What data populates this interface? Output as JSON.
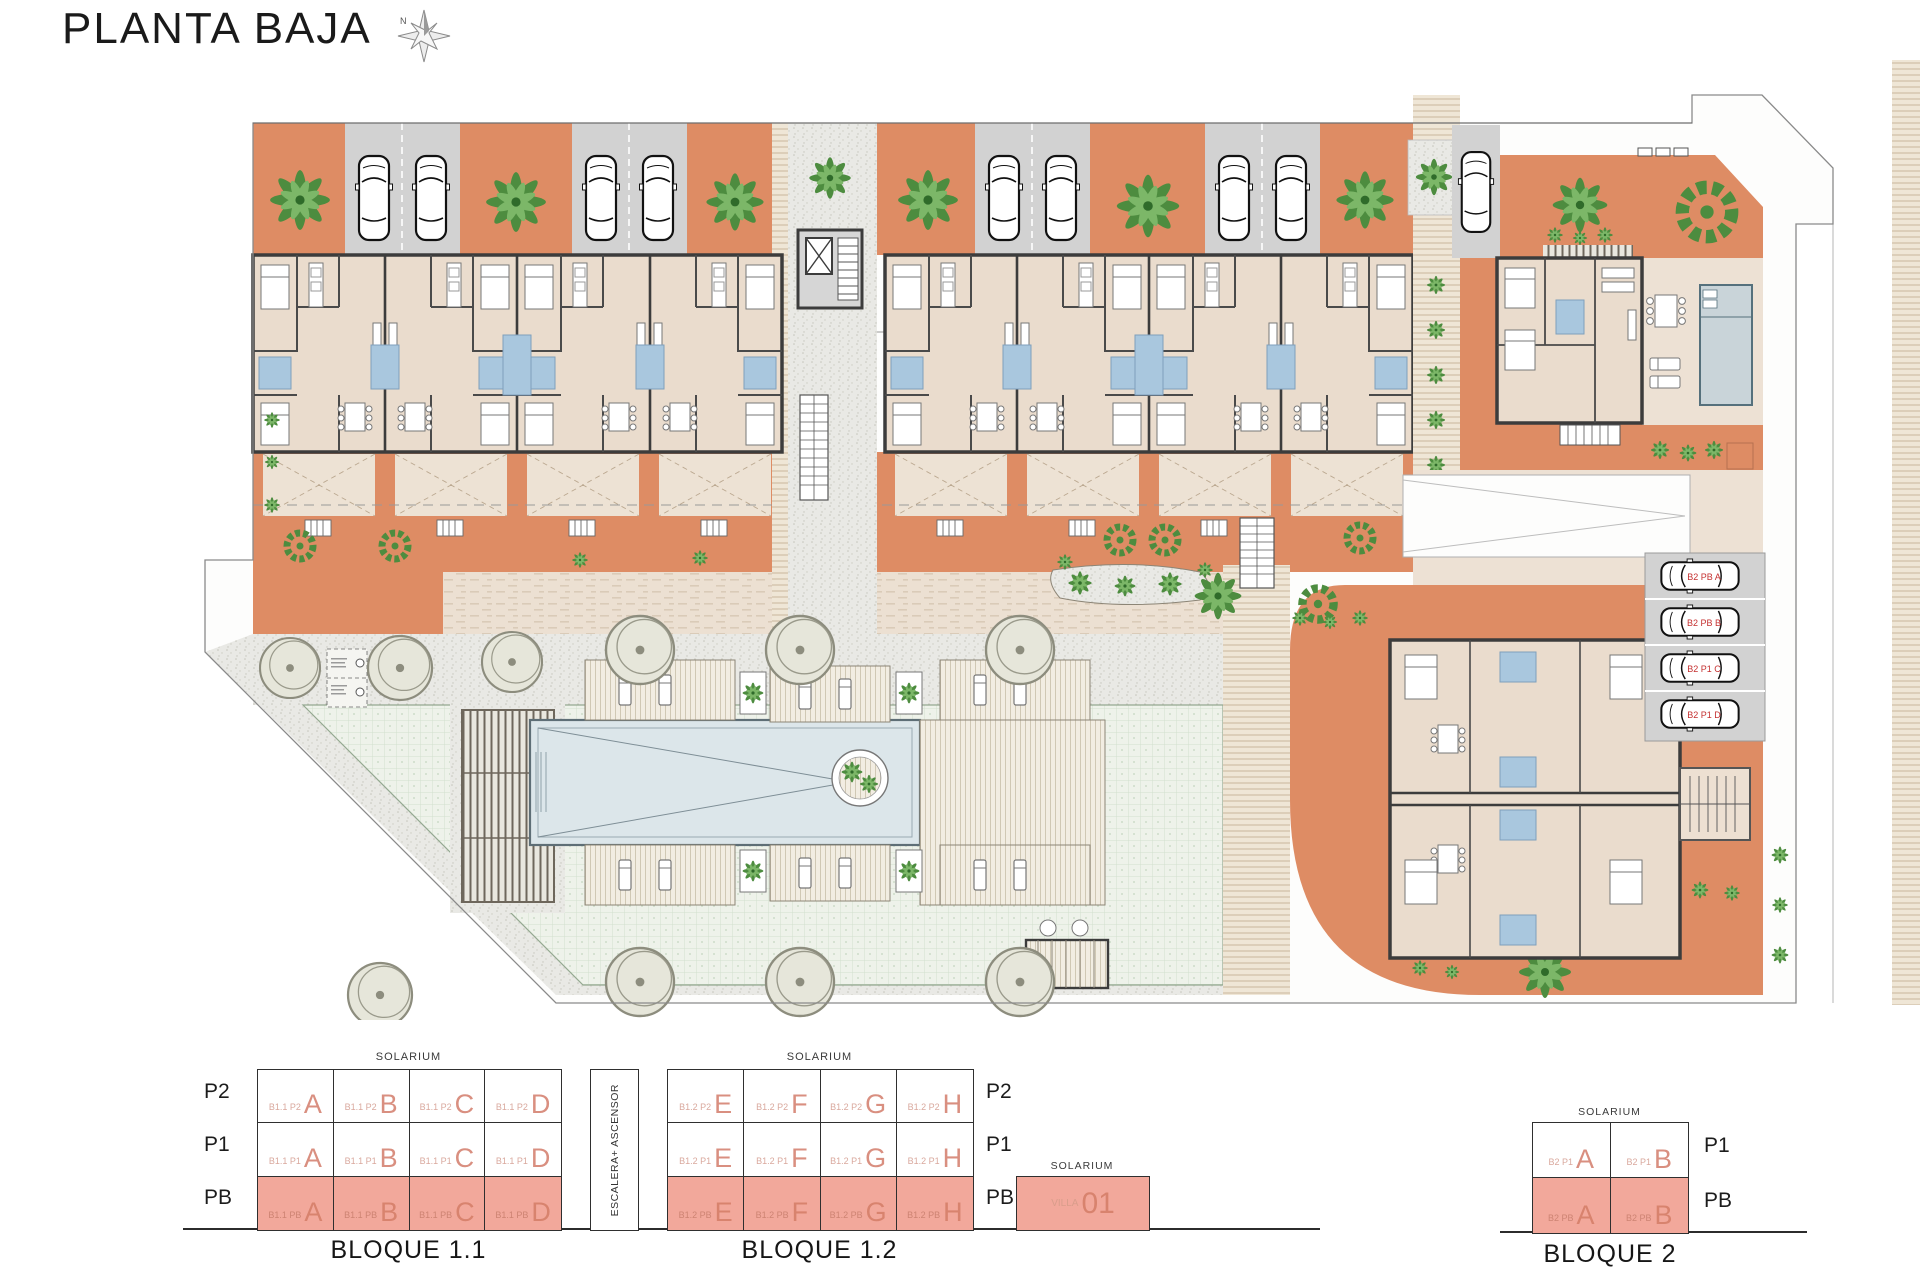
{
  "header": {
    "title": "PLANTA BAJA",
    "compass_label": "N"
  },
  "plan": {
    "parking_labels": [
      "B2 PB A",
      "B2 PB B",
      "B2 P1 C",
      "B2 P1 D"
    ],
    "colors": {
      "terracotta": "#DE8C64",
      "building": "#EADCCD",
      "wall": "#3C3C3C",
      "parking": "#D2D2D2",
      "bath_blue": "#A9C7DE",
      "pool": "#DCE6EA",
      "lawn": "#EDF2E9",
      "highlight_salmon": "#F2A89B"
    }
  },
  "legend": {
    "bloque11": {
      "title": "BLOQUE 1.1",
      "solarium": "SOLARIUM",
      "row_labels": [
        "P2",
        "P1",
        "PB"
      ],
      "rows": [
        {
          "cells": [
            {
              "code": "B1.1 P2",
              "letter": "A"
            },
            {
              "code": "B1.1 P2",
              "letter": "B"
            },
            {
              "code": "B1.1 P2",
              "letter": "C"
            },
            {
              "code": "B1.1 P2",
              "letter": "D"
            }
          ]
        },
        {
          "cells": [
            {
              "code": "B1.1 P1",
              "letter": "A"
            },
            {
              "code": "B1.1 P1",
              "letter": "B"
            },
            {
              "code": "B1.1 P1",
              "letter": "C"
            },
            {
              "code": "B1.1 P1",
              "letter": "D"
            }
          ]
        },
        {
          "cells": [
            {
              "code": "B1.1 PB",
              "letter": "A"
            },
            {
              "code": "B1.1 PB",
              "letter": "B"
            },
            {
              "code": "B1.1 PB",
              "letter": "C"
            },
            {
              "code": "B1.1 PB",
              "letter": "D"
            }
          ]
        }
      ]
    },
    "bloque12": {
      "title": "BLOQUE 1.2",
      "solarium": "SOLARIUM",
      "core_label": "ESCALERA+ ASCENSOR",
      "row_labels": [
        "P2",
        "P1",
        "PB"
      ],
      "rows": [
        {
          "cells": [
            {
              "code": "B1.2 P2",
              "letter": "E"
            },
            {
              "code": "B1.2 P2",
              "letter": "F"
            },
            {
              "code": "B1.2 P2",
              "letter": "G"
            },
            {
              "code": "B1.2 P2",
              "letter": "H"
            }
          ]
        },
        {
          "cells": [
            {
              "code": "B1.2 P1",
              "letter": "E"
            },
            {
              "code": "B1.2 P1",
              "letter": "F"
            },
            {
              "code": "B1.2 P1",
              "letter": "G"
            },
            {
              "code": "B1.2 P1",
              "letter": "H"
            }
          ]
        },
        {
          "cells": [
            {
              "code": "B1.2 PB",
              "letter": "E"
            },
            {
              "code": "B1.2 PB",
              "letter": "F"
            },
            {
              "code": "B1.2 PB",
              "letter": "G"
            },
            {
              "code": "B1.2 PB",
              "letter": "H"
            }
          ]
        }
      ]
    },
    "villa": {
      "solarium": "SOLARIUM",
      "code": "VILLA",
      "number": "01"
    },
    "bloque2": {
      "title": "BLOQUE 2",
      "solarium": "SOLARIUM",
      "row_labels": [
        "P1",
        "PB"
      ],
      "rows": [
        {
          "cells": [
            {
              "code": "B2 P1",
              "letter": "A"
            },
            {
              "code": "B2 P1",
              "letter": "B"
            }
          ]
        },
        {
          "cells": [
            {
              "code": "B2 PB",
              "letter": "A"
            },
            {
              "code": "B2 PB",
              "letter": "B"
            }
          ]
        }
      ]
    }
  }
}
